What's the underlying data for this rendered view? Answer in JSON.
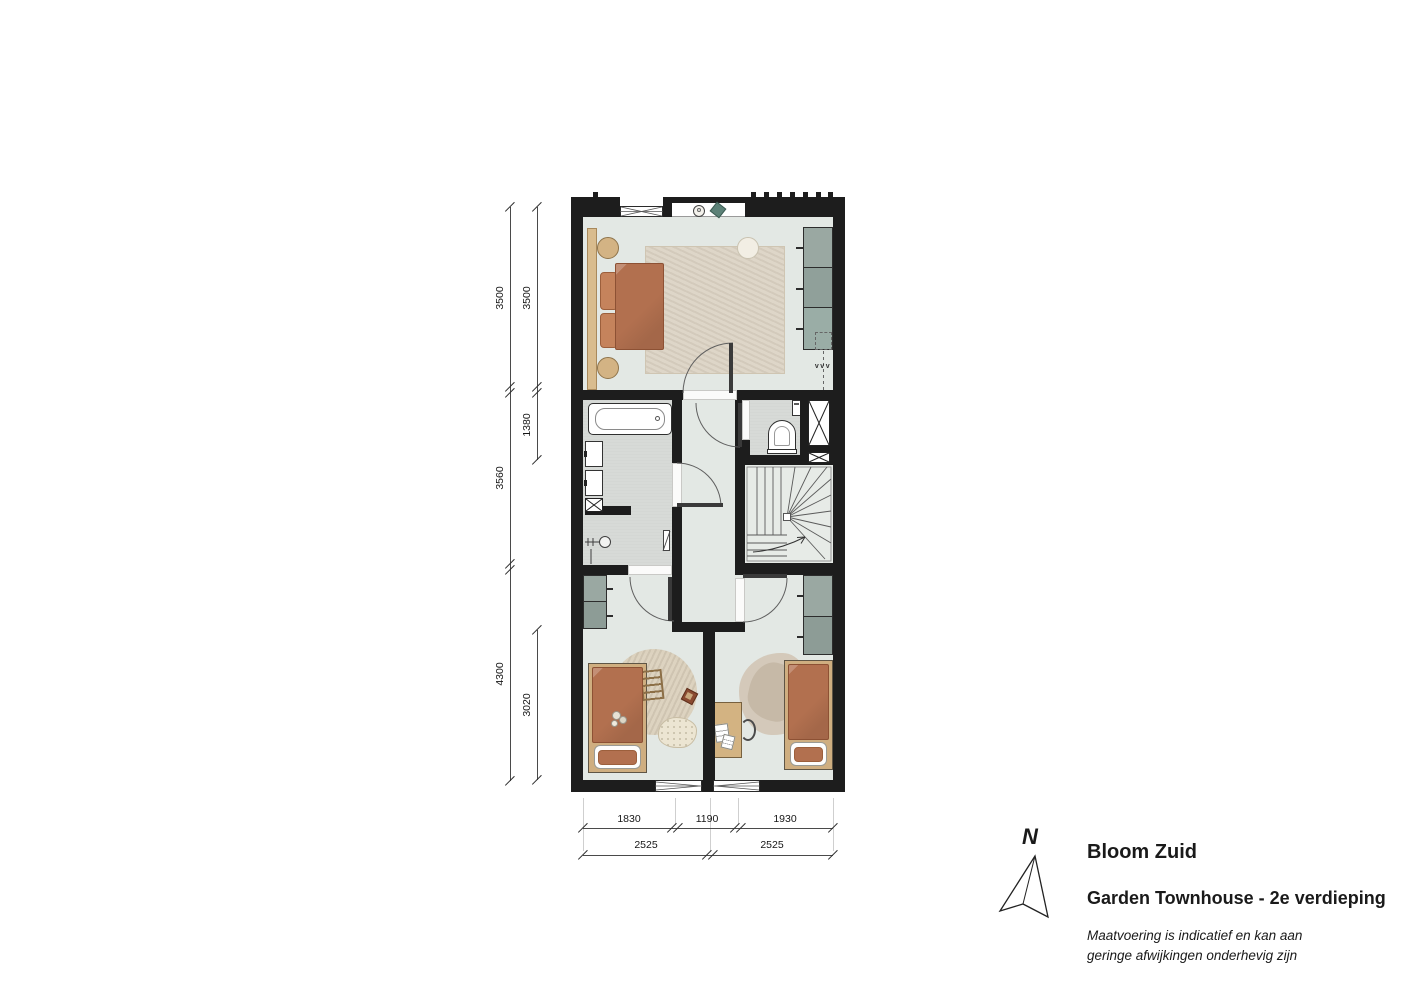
{
  "title_block": {
    "north_label": "N",
    "project_title": "Bloom Zuid",
    "floor_title": "Garden Townhouse - 2e verdieping",
    "disclaimer_line1": "Maatvoering is indicatief en kan aan",
    "disclaimer_line2": "geringe afwijkingen onderhevig zijn"
  },
  "dimensions": {
    "left_outer": [
      "3500",
      "3560",
      "4300"
    ],
    "left_inner": [
      "3500",
      "1380",
      "3020"
    ],
    "bottom_row1": [
      "1830",
      "1190",
      "1930"
    ],
    "bottom_row2": [
      "2525",
      "2525"
    ]
  },
  "plan_annotations": {
    "vent_label": "vvv"
  },
  "colors": {
    "wall": "#1d1d1d",
    "floor_main": "#e3e8e4",
    "floor_wet": "#d7dad7",
    "closet": "#93a29c",
    "bed_terracotta": "#b2704f",
    "wood": "#cfae80",
    "teal_decor": "#5d8278"
  }
}
